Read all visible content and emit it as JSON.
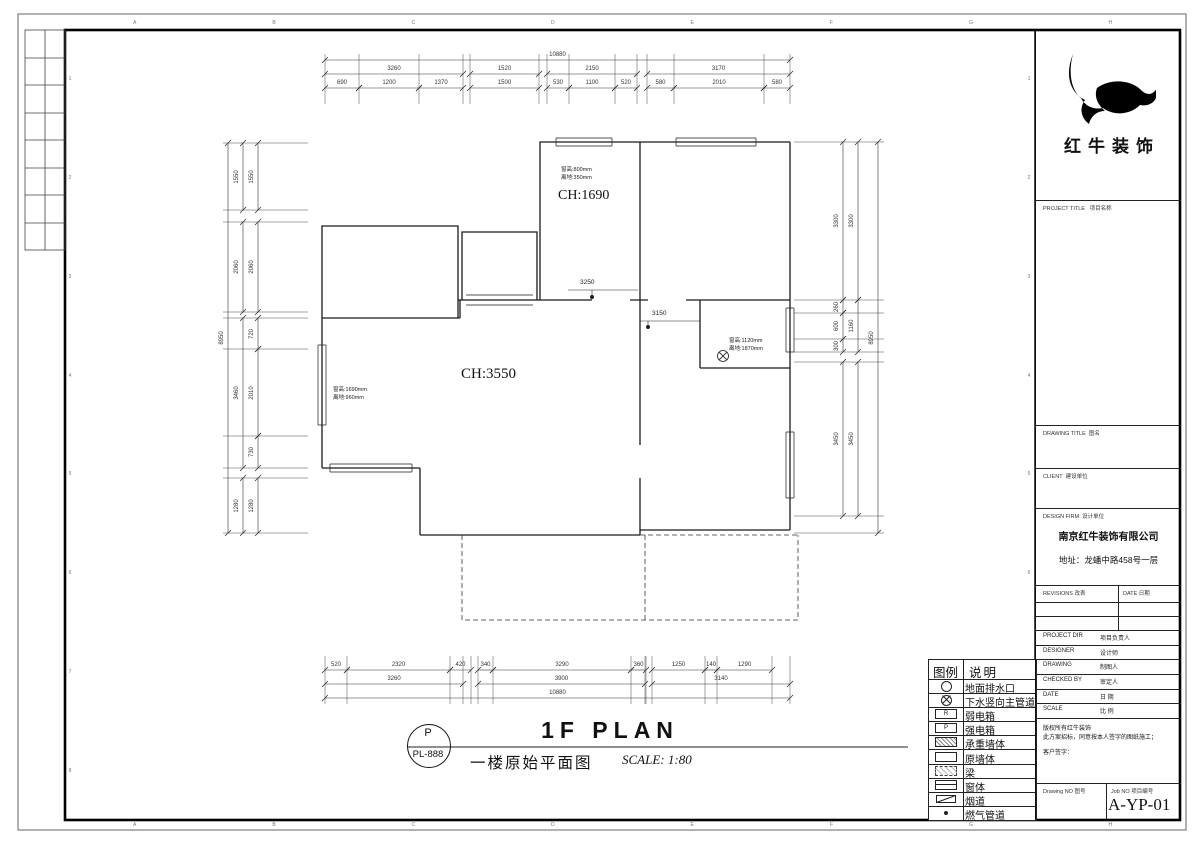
{
  "sheet": {
    "zone_letters": [
      "A",
      "B",
      "C",
      "D",
      "E",
      "F",
      "G",
      "H"
    ],
    "zone_numbers": [
      "1",
      "2",
      "3",
      "4",
      "5",
      "6",
      "7",
      "8"
    ]
  },
  "title_block": {
    "company": "红牛装饰",
    "project_title_en": "PROJECT TITLE",
    "project_title_zh": "项目名称",
    "drawing_title_en": "DRAWING TITLE",
    "drawing_title_zh": "图名",
    "client_en": "CLIENT",
    "client_zh": "建设单位",
    "design_firm_en": "DESIGN FIRM",
    "design_firm_zh": "设计单位",
    "firm_name": "南京红牛装饰有限公司",
    "firm_address": "地址：龙蟠中路458号一层",
    "revisions_en": "REVISIONS",
    "revisions_zh": "改表",
    "date_en": "DATE",
    "date_zh": "日期",
    "rows": [
      {
        "en": "PROJECT DIR",
        "zh": "项目负责人"
      },
      {
        "en": "DESIGNER",
        "zh": "设计师"
      },
      {
        "en": "DRAWING",
        "zh": "制图人"
      },
      {
        "en": "CHECKED BY",
        "zh": "审定人"
      },
      {
        "en": "DATE",
        "zh": "日 期"
      },
      {
        "en": "SCALE",
        "zh": "比 例"
      }
    ],
    "copyright_lines": [
      "版权所有红牛装饰",
      "此方案招标，同意按本人签字的图纸施工；",
      "客户签字："
    ],
    "drawing_no_en": "Drawing NO",
    "drawing_no_zh": "图号",
    "job_no_en": "Job NO",
    "job_no_zh": "项目编号",
    "drawing_no": "A-YP-01"
  },
  "legend": {
    "header_symbol": "图例",
    "header_desc": "说明",
    "items": [
      {
        "symbol": "drain-circle",
        "label": "地面排水口"
      },
      {
        "symbol": "drain-cross-circle",
        "label": "下水竖向主管道"
      },
      {
        "symbol": "weak-power-box",
        "letter": "R",
        "label": "弱电箱"
      },
      {
        "symbol": "strong-power-box",
        "letter": "P",
        "label": "强电箱"
      },
      {
        "symbol": "bearing-wall-hatch",
        "label": "承重墙体"
      },
      {
        "symbol": "original-wall",
        "label": "原墙体"
      },
      {
        "symbol": "beam",
        "label": "梁"
      },
      {
        "symbol": "window",
        "label": "窗体"
      },
      {
        "symbol": "flue",
        "label": "烟道"
      },
      {
        "symbol": "gas-pipe-dot",
        "label": "燃气管道"
      }
    ]
  },
  "plan": {
    "room_top_label": "CH:1690",
    "room_main_label": "CH:3550",
    "ann_top": [
      "窗高:800mm",
      "离地:350mm"
    ],
    "ann_left": [
      "窗高:1690mm",
      "离地:960mm"
    ],
    "ann_right": [
      "窗高:1120mm",
      "离地:1870mm"
    ],
    "leader_1": "3250",
    "leader_2": "3150"
  },
  "dims": {
    "top": {
      "overall": "10880",
      "groups": [
        "3260",
        "1520",
        "2150",
        "3170"
      ],
      "subs": [
        "690",
        "1200",
        "1370",
        "1500",
        "530",
        "1100",
        "520",
        "580",
        "2010",
        "580"
      ]
    },
    "bottom": {
      "subs": [
        "520",
        "2320",
        "420",
        "340",
        "3290",
        "360",
        "1250",
        "140",
        "1290"
      ],
      "groups": [
        "3260",
        "3900",
        "3140"
      ],
      "overall": "10880"
    },
    "left": {
      "outer": "8950",
      "mid": [
        "1550",
        "2060",
        "3460",
        "1280"
      ],
      "inner": [
        "1550",
        "2060",
        "720",
        "2010",
        "730",
        "1280"
      ]
    },
    "right": {
      "inner": [
        "3300",
        "260",
        "600",
        "300",
        "3450"
      ],
      "mid": [
        "3300",
        "1160",
        "3450"
      ],
      "outer": "8950"
    }
  },
  "footer": {
    "stamp_top": "P",
    "stamp_bottom": "PL-888",
    "title_en": "1F PLAN",
    "title_zh": "一楼原始平面图",
    "scale": "SCALE: 1:80"
  }
}
